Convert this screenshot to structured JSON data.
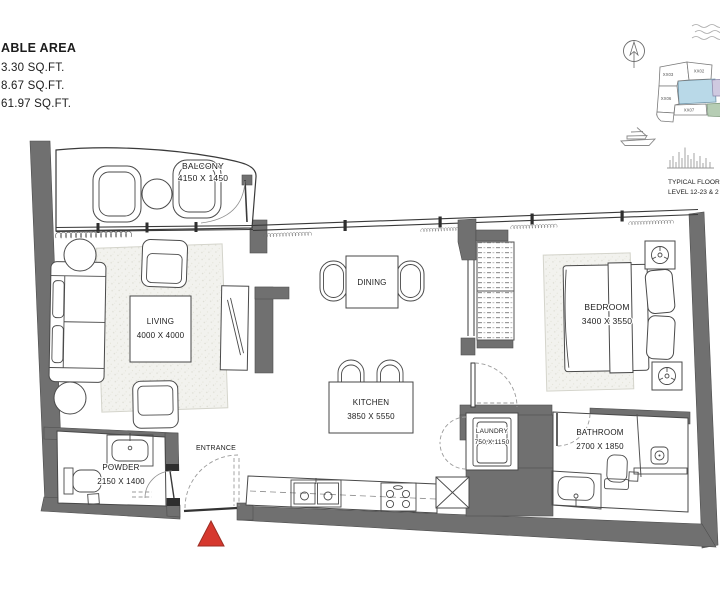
{
  "colors": {
    "wall_gray": "#707070",
    "entrance_marker_red": "#d6382e",
    "keyplan_highlight_blue": "#b9d9e8",
    "keyplan_purple": "#cfc9e0",
    "keyplan_green": "#b6cdb4",
    "background": "#ffffff"
  },
  "area_panel": {
    "title": "ABLE AREA",
    "line1": "3.30 SQ.FT.",
    "line2": "8.67 SQ.FT.",
    "line3": "61.97 SQ.FT."
  },
  "rooms": {
    "balcony": {
      "name": "BALCONY",
      "dims": "4150 X 1450"
    },
    "living": {
      "name": "LIVING",
      "dims": "4000 X 4000"
    },
    "dining": {
      "name": "DINING"
    },
    "kitchen": {
      "name": "KITCHEN",
      "dims": "3850 X 5550"
    },
    "bedroom": {
      "name": "BEDROOM",
      "dims": "3400 X 3550"
    },
    "laundry": {
      "name": "LAUNDRY",
      "dims": "750 X 1150"
    },
    "bathroom": {
      "name": "BATHROOM",
      "dims": "2700 X 1850"
    },
    "powder": {
      "name": "POWDER",
      "dims": "2150 X 1400"
    },
    "entrance": {
      "name": "ENTRANCE"
    }
  },
  "keyplan": {
    "units": [
      {
        "label": "XX03"
      },
      {
        "label": "XX02"
      },
      {
        "label": "XX06"
      },
      {
        "label": "XX07"
      }
    ],
    "footnote_line1": "TYPICAL FLOOR",
    "footnote_line2": "LEVEL 12-23 & 2"
  }
}
